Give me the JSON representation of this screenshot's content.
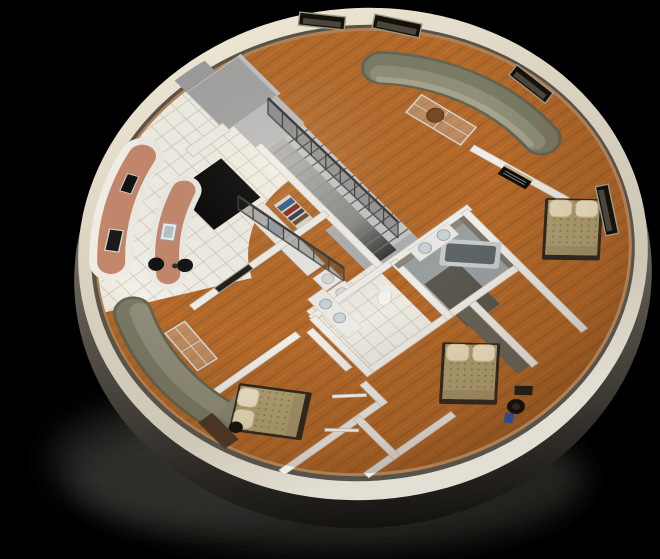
{
  "scene": {
    "description": "3D cutaway rendering of a circular dome-home floor plan viewed from above on a black background",
    "background": "#000000"
  },
  "palette": {
    "wood": "#b4692a",
    "wood_light": "#c98036",
    "wood_stripe": "#8f5a22",
    "tile": "#f2efe6",
    "tile_line": "#cfcabd",
    "rim": "#ece4d0",
    "rim_shade": "#c9c2b1",
    "outer_wall_dark": "#23211d",
    "inner_ledge": "#57524a",
    "ledge_tan": "#b08052",
    "wall_top": "#f0eee8",
    "wall_shadow": "#7b756b",
    "stair_light": "#c6c6c6",
    "stair_dark": "#3a3a3a",
    "platform": "#a2a2a2",
    "sofa": "#908f7a",
    "sofa_back": "#7c7b66",
    "counter_terracotta": "#c4876b",
    "bedspread": "#b3a274",
    "pillow": "#ecdebc",
    "bath_floor": "#9aa0a0",
    "tub": "#5e6567",
    "glass": "#d4dbdd",
    "bowl_brown": "#7a4a22",
    "book_blue": "#2e5d8a",
    "book_red": "#8a2a22",
    "accent_blue": "#2a5cb8",
    "void_black": "#060606"
  },
  "rooms": [
    {
      "name": "living-room-northeast",
      "floor": "wood",
      "furniture": [
        "curved-sectional-sofa",
        "glass-coffee-table",
        "decorative-bowl"
      ]
    },
    {
      "name": "living-room-southwest",
      "floor": "wood",
      "furniture": [
        "curved-sectional-sofa",
        "glass-coffee-table"
      ]
    },
    {
      "name": "kitchen",
      "floor": "tile",
      "furniture": [
        "perimeter-counter",
        "curved-island-counter",
        "island-sink",
        "bar-stools",
        "oven",
        "range"
      ]
    },
    {
      "name": "utility-hall",
      "floor": "tile",
      "furniture": [
        "counter-with-sink",
        "washer",
        "dryer",
        "bookshelf",
        "wall-tv-panel"
      ]
    },
    {
      "name": "bedroom-east",
      "floor": "wood",
      "furniture": [
        "double-bed",
        "media-console"
      ]
    },
    {
      "name": "bedroom-southeast",
      "floor": "wood",
      "furniture": [
        "double-bed",
        "office-chair",
        "blue-bag",
        "small-desk"
      ]
    },
    {
      "name": "bedroom-south",
      "floor": "wood",
      "furniture": [
        "double-bed",
        "desk",
        "desk-chair"
      ]
    },
    {
      "name": "bathroom-master",
      "floor": "gray",
      "furniture": [
        "corner-bathtub",
        "double-sink-counter"
      ]
    },
    {
      "name": "bathroom-second",
      "floor": "tile",
      "furniture": [
        "double-sink-counter",
        "toilet"
      ]
    },
    {
      "name": "stair-hall",
      "floor": "gray",
      "furniture": [
        "switchback-staircase",
        "entry-platform",
        "stairwell-opening"
      ]
    }
  ],
  "stairs": {
    "flights": 2,
    "steps_per_flight": 13,
    "railings": 2,
    "railing_posts": [
      9,
      7
    ]
  },
  "structure": {
    "rim_vents": 4,
    "entry_platform": true,
    "stairwell_opening": true,
    "bedrooms": 3,
    "bathrooms": 2
  }
}
